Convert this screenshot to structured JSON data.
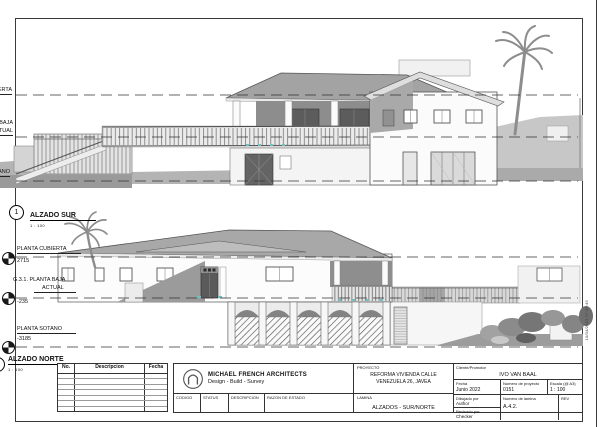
{
  "sheet": {
    "plot_stamp": "10/04/2023 17:35:45"
  },
  "south_elevation": {
    "view_number": "1",
    "title": "ALZADO SUR",
    "scale": "1 : 100",
    "level_cubierta": "PLANTA CUBIERTA",
    "level_baja_line1": "PLANTA BAJA",
    "level_baja_line2": "ACTUAL",
    "level_sotano": "PLANTA SOTANO"
  },
  "north_elevation": {
    "title": "ALZADO NORTE",
    "scale": "1 : 100",
    "level_cubierta": "PLANTA CUBIERTA",
    "level_cubierta_value": "2715",
    "level_baja_line1": "G.3.1. PLANTA BAJA",
    "level_baja_line2": "ACTUAL",
    "level_baja_value": "-235",
    "level_sotano": "PLANTA SOTANO",
    "level_sotano_value": "-3185"
  },
  "title_block": {
    "revision_table": {
      "col_no": "No.",
      "col_descripcion": "Descripcion",
      "col_fecha": "Fecha"
    },
    "architect_name": "MICHAEL FRENCH ARCHITECTS",
    "architect_tagline": "Design - Build - Survey",
    "status_codigo": "CODIGO",
    "status_status": "STATUS",
    "status_descripcion": "DESCRIPCION",
    "status_razon": "RAZON DE ESTADO",
    "proyecto_label": "PROYECTO",
    "proyecto_value": "REFORMA VIVIENDA CALLE VENEZUELA 26, JAVEA",
    "lamina_label": "LAMINA",
    "lamina_value": "ALZADOS - SUR/NORTE",
    "cliente_label": "Cliente/Promotor",
    "cliente_value": "IVO VAN BAAL",
    "fecha_label": "Fecha",
    "fecha_value": "Junio 2022",
    "num_proyecto_label": "Numero de proyecto",
    "num_proyecto_value": "0151",
    "escala_label": "Escala (@ A3)",
    "escala_value": "1 : 100",
    "dibujado_label": "Dibujado por",
    "dibujado_value": "Author",
    "revisado_label": "Revisado por",
    "revisado_value": "Checker",
    "num_lamina_label": "Numero de lamina",
    "num_lamina_value": "A.4.2.",
    "rev_label": "REV"
  }
}
